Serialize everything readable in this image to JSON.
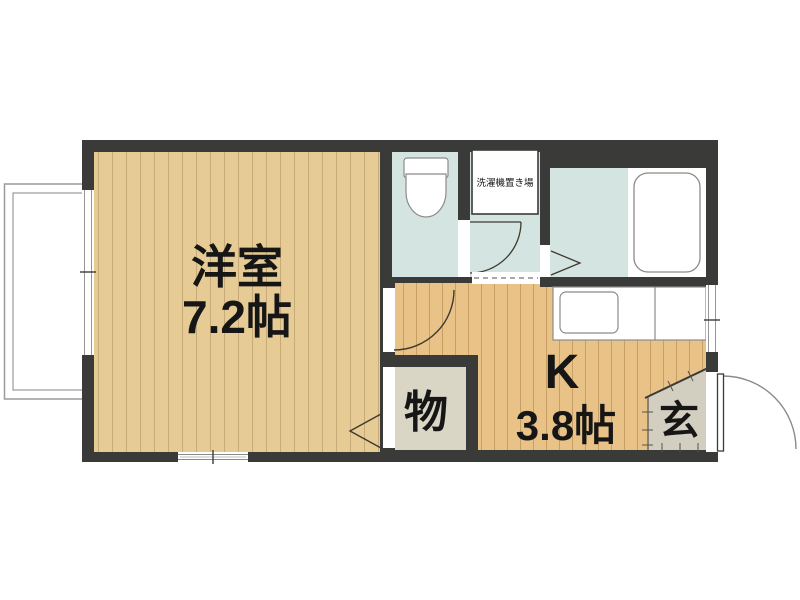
{
  "floor_plan": {
    "type": "japanese-apartment-1K",
    "rooms": {
      "western": {
        "name": "洋室",
        "area": "7.2帖"
      },
      "kitchen": {
        "name": "K",
        "area": "3.8帖"
      },
      "closet": {
        "name": "物"
      },
      "entrance": {
        "name": "玄"
      },
      "laundry": {
        "name": "洗濯機置き場"
      }
    },
    "fixtures": [
      "toilet-icon",
      "bathtub-icon",
      "kitchen-sink-icon",
      "washing-machine-area",
      "entrance-door",
      "balcony"
    ],
    "colors": {
      "wall": "#3a3a38",
      "western_room_floor": "#e6cb94",
      "western_room_stripe": "#c6aa78",
      "kitchen_floor": "#e8c286",
      "kitchen_stripe": "#c79e63",
      "wet_area": "#d4e4e1",
      "closet_floor": "#dad6c6",
      "entrance_floor": "#d2cec0",
      "label_text": "#161616"
    }
  }
}
